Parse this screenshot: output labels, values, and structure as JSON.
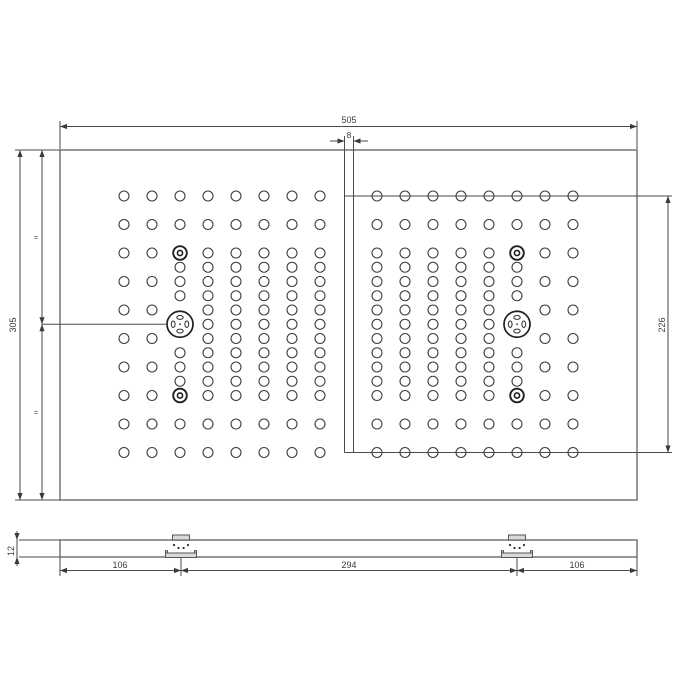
{
  "drawing": {
    "canvas": {
      "w": 700,
      "h": 700
    },
    "colors": {
      "line": "#4a4a4a",
      "plate_edge": "#7c7c7c",
      "hole": "#3d3d3d",
      "bracket_fill": "#d9d9d9",
      "text": "#3a3a3a"
    },
    "dim_labels": {
      "overall_width": "505",
      "slot_width": "8",
      "overall_height": "305",
      "hole_span_right": "226",
      "thickness": "12",
      "bracket_left_offset": "106",
      "bracket_spacing": "294",
      "bracket_right_offset": "106",
      "equal_marks": [
        "=",
        "="
      ]
    },
    "top_view": {
      "plate": {
        "x": 60,
        "y": 150,
        "w": 577,
        "h": 350
      },
      "slot_lines_x": [
        344.5,
        353.5
      ],
      "slot_top": 136,
      "slot_bottom": 452.5,
      "hole_r": 5,
      "ring": {
        "outer_r": 6.8,
        "inner_r": 2.6
      },
      "big": {
        "r": 13,
        "slot_off": 6.8,
        "slot_rx": 3.2,
        "slot_ry": 1.9,
        "dot_r": 0.9
      },
      "grids": [
        {
          "name": "left",
          "cols": [
            124,
            152,
            180,
            208,
            236,
            264,
            292,
            320
          ],
          "rows": [
            196,
            224.5,
            253,
            281.5,
            310,
            338.5,
            367,
            395.5,
            424,
            452.5
          ],
          "dense_cols": [
            180,
            208,
            236,
            264,
            292,
            320
          ],
          "dense_rows": [
            267.25,
            295.75,
            324.25,
            352.75,
            381.25
          ],
          "feature_col": 180,
          "feature_skip_rows": [
            253,
            310,
            338.5,
            395.5
          ],
          "ring_rows": [
            253,
            395.5
          ],
          "big_row": 324.25
        },
        {
          "name": "right",
          "cols": [
            377,
            405,
            433,
            461,
            489,
            517,
            545,
            573
          ],
          "rows": [
            196,
            224.5,
            253,
            281.5,
            310,
            338.5,
            367,
            395.5,
            424,
            452.5
          ],
          "dense_cols": [
            377,
            405,
            433,
            461,
            489,
            517
          ],
          "dense_rows": [
            267.25,
            295.75,
            324.25,
            352.75,
            381.25
          ],
          "feature_col": 517,
          "feature_skip_rows": [
            253,
            310,
            338.5,
            395.5
          ],
          "ring_rows": [
            253,
            395.5
          ],
          "big_row": 324.25
        }
      ]
    },
    "section_view": {
      "bar": {
        "x": 60,
        "y": 540,
        "w": 577,
        "h": 17
      },
      "bracket_centers": [
        181,
        517
      ],
      "tab": {
        "w": 17,
        "h": 5
      },
      "base": {
        "w": 31,
        "h": 4.5
      },
      "post": {
        "w": 2,
        "h": 2.4
      },
      "dots": {
        "outer_dx": 7,
        "outer_y": 545,
        "inner_dx": 2.6,
        "inner_y": 548,
        "r": 1.1
      }
    },
    "annotations": {
      "lines": [
        [
          60,
          121,
          60,
          149
        ],
        [
          637,
          121,
          637,
          149
        ],
        [
          60,
          126.5,
          637,
          126.5
        ],
        [
          330,
          141,
          344.5,
          141
        ],
        [
          353.5,
          141,
          368,
          141
        ],
        [
          15,
          150,
          60,
          150
        ],
        [
          15,
          500,
          60,
          500
        ],
        [
          20,
          150,
          20,
          500
        ],
        [
          42,
          150,
          42,
          500
        ],
        [
          42,
          324.25,
          167,
          324.25
        ],
        [
          344.5,
          196,
          672,
          196
        ],
        [
          344.5,
          452.5,
          672,
          452.5
        ],
        [
          668,
          196,
          668,
          452.5
        ],
        [
          19,
          540,
          60,
          540
        ],
        [
          19,
          557,
          60,
          557
        ],
        [
          17,
          531,
          17,
          566
        ],
        [
          60,
          557,
          60,
          576
        ],
        [
          637,
          557,
          637,
          576
        ],
        [
          181,
          558,
          181,
          576
        ],
        [
          517,
          558,
          517,
          576
        ],
        [
          60,
          570.5,
          637,
          570.5
        ]
      ],
      "arrows": [
        [
          60,
          126.5,
          "left"
        ],
        [
          637,
          126.5,
          "right"
        ],
        [
          344.5,
          141,
          "right"
        ],
        [
          353.5,
          141,
          "left"
        ],
        [
          20,
          150,
          "up"
        ],
        [
          20,
          500,
          "down"
        ],
        [
          42,
          150,
          "up"
        ],
        [
          42,
          324.25,
          "down"
        ],
        [
          42,
          324.25,
          "up"
        ],
        [
          42,
          500,
          "down"
        ],
        [
          668,
          196,
          "up"
        ],
        [
          668,
          452.5,
          "down"
        ],
        [
          17,
          540,
          "down"
        ],
        [
          17,
          557,
          "up"
        ],
        [
          60,
          570.5,
          "left"
        ],
        [
          181,
          570.5,
          "right"
        ],
        [
          181,
          570.5,
          "left"
        ],
        [
          517,
          570.5,
          "right"
        ],
        [
          517,
          570.5,
          "left"
        ],
        [
          637,
          570.5,
          "right"
        ]
      ],
      "texts": [
        {
          "name": "dim-overall-width",
          "x": 349,
          "y": 123,
          "s": "505",
          "size": 9
        },
        {
          "name": "dim-slot-width",
          "x": 349,
          "y": 138,
          "s": "8",
          "size": 8.5
        },
        {
          "name": "dim-overall-height",
          "x": 16,
          "y": 325,
          "s": "305",
          "size": 9,
          "rot": -90
        },
        {
          "name": "equal-mark-top",
          "x": 36,
          "y": 240,
          "s": "=",
          "size": 7
        },
        {
          "name": "equal-mark-bottom",
          "x": 36,
          "y": 415,
          "s": "=",
          "size": 7
        },
        {
          "name": "dim-hole-span",
          "x": 665,
          "y": 325,
          "s": "226",
          "size": 9,
          "rot": -90
        },
        {
          "name": "dim-thickness",
          "x": 14,
          "y": 551,
          "s": "12",
          "size": 9,
          "rot": -90
        },
        {
          "name": "dim-bracket-left-offset",
          "x": 120,
          "y": 568,
          "s": "106",
          "size": 9
        },
        {
          "name": "dim-bracket-spacing",
          "x": 349,
          "y": 568,
          "s": "294",
          "size": 9
        },
        {
          "name": "dim-bracket-right-offset",
          "x": 577,
          "y": 568,
          "s": "106",
          "size": 9
        }
      ]
    }
  }
}
